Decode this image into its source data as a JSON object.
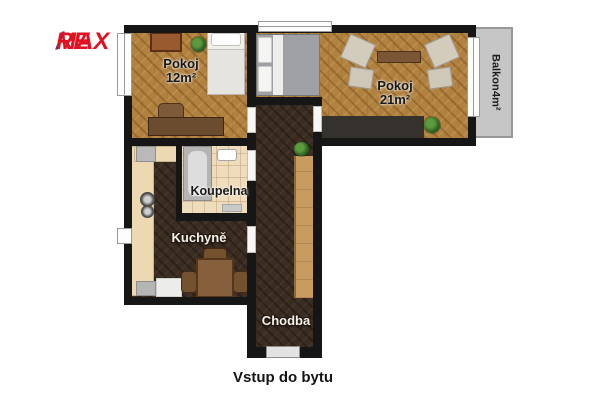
{
  "logo": {
    "part1": "RE",
    "slash": "/",
    "part2": "MAX",
    "red": "#e01220",
    "blue": "#24409a"
  },
  "plan": {
    "rooms": [
      {
        "id": "pokoj-12",
        "name": "Pokoj",
        "area": "12m²"
      },
      {
        "id": "pokoj-21",
        "name": "Pokoj",
        "area": "21m²"
      },
      {
        "id": "koupelna",
        "name": "Koupelna"
      },
      {
        "id": "kuchyne",
        "name": "Kuchyně"
      },
      {
        "id": "chodba",
        "name": "Chodba"
      },
      {
        "id": "balkon",
        "name": "Balkon",
        "area": "4m²"
      }
    ],
    "entrance_label": "Vstup do bytu",
    "colors": {
      "wall": "#161616",
      "wood_floor": "#b0813f",
      "dark_floor": "#3b2c21",
      "tile_floor": "#eedcbc",
      "balcony": "#c6c6c6",
      "background": "#ffffff"
    }
  }
}
